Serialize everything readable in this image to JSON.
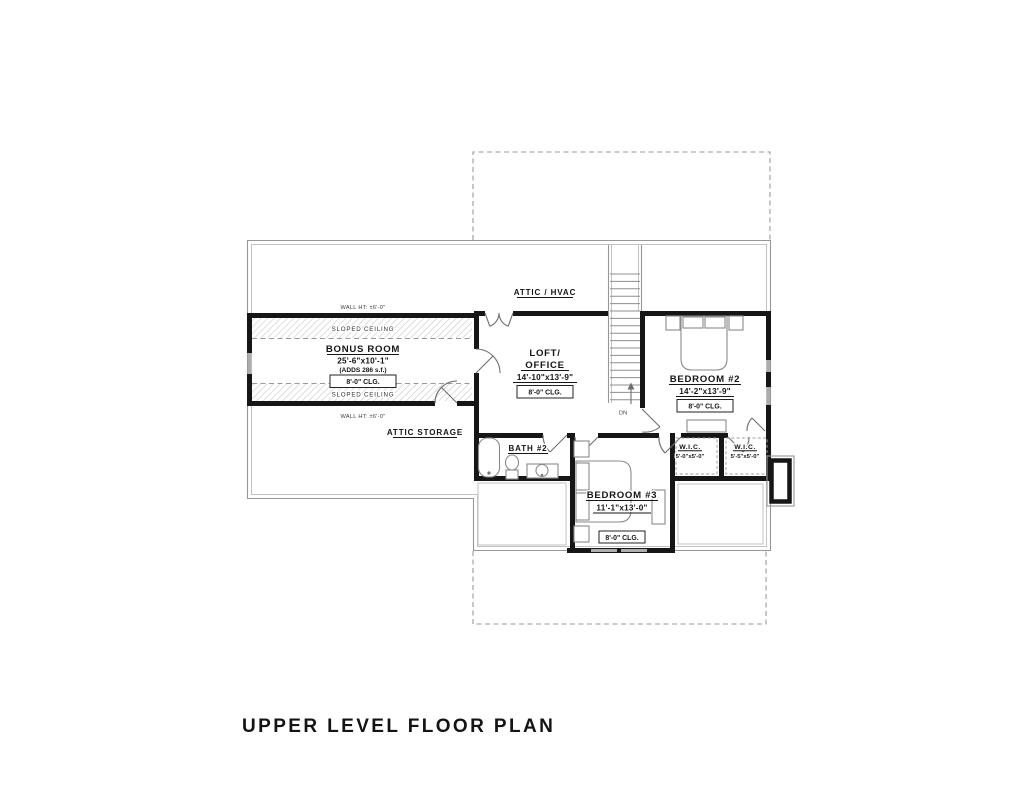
{
  "title": "UPPER LEVEL FLOOR PLAN",
  "accent_colors": {
    "wall": "#161616",
    "thin_line": "#979797",
    "background": "#ffffff"
  },
  "labels": {
    "wall_ht_top": "WALL HT: ±6'-0\"",
    "wall_ht_bottom": "WALL HT: ±6'-0\"",
    "sloped_ceiling_top": "SLOPED CEILING",
    "sloped_ceiling_bottom": "SLOPED CEILING",
    "attic_hvac": "ATTIC / HVAC",
    "attic_storage": "ATTIC STORAGE",
    "stairs_down": "DN"
  },
  "rooms": {
    "bonus": {
      "name": "BONUS ROOM",
      "dims": "25'-6\"x10'-1\"",
      "note": "(ADDS 286 s.f.)",
      "clg": "8'-0\" CLG."
    },
    "loft": {
      "name_line1": "LOFT/",
      "name_line2": "OFFICE",
      "dims": "14'-10\"x13'-9\"",
      "clg": "8'-0\" CLG."
    },
    "bedroom2": {
      "name": "BEDROOM #2",
      "dims": "14'-2\"x13'-9\"",
      "clg": "8'-0\" CLG."
    },
    "bedroom3": {
      "name": "BEDROOM #3",
      "dims": "11'-1\"x13'-0\"",
      "clg": "8'-0\" CLG."
    },
    "bath2": {
      "name": "BATH #2"
    },
    "wic1": {
      "name": "W.I.C.",
      "dims": "5'-0\"x5'-0\""
    },
    "wic2": {
      "name": "W.I.C.",
      "dims": "5'-5\"x5'-0\""
    }
  }
}
